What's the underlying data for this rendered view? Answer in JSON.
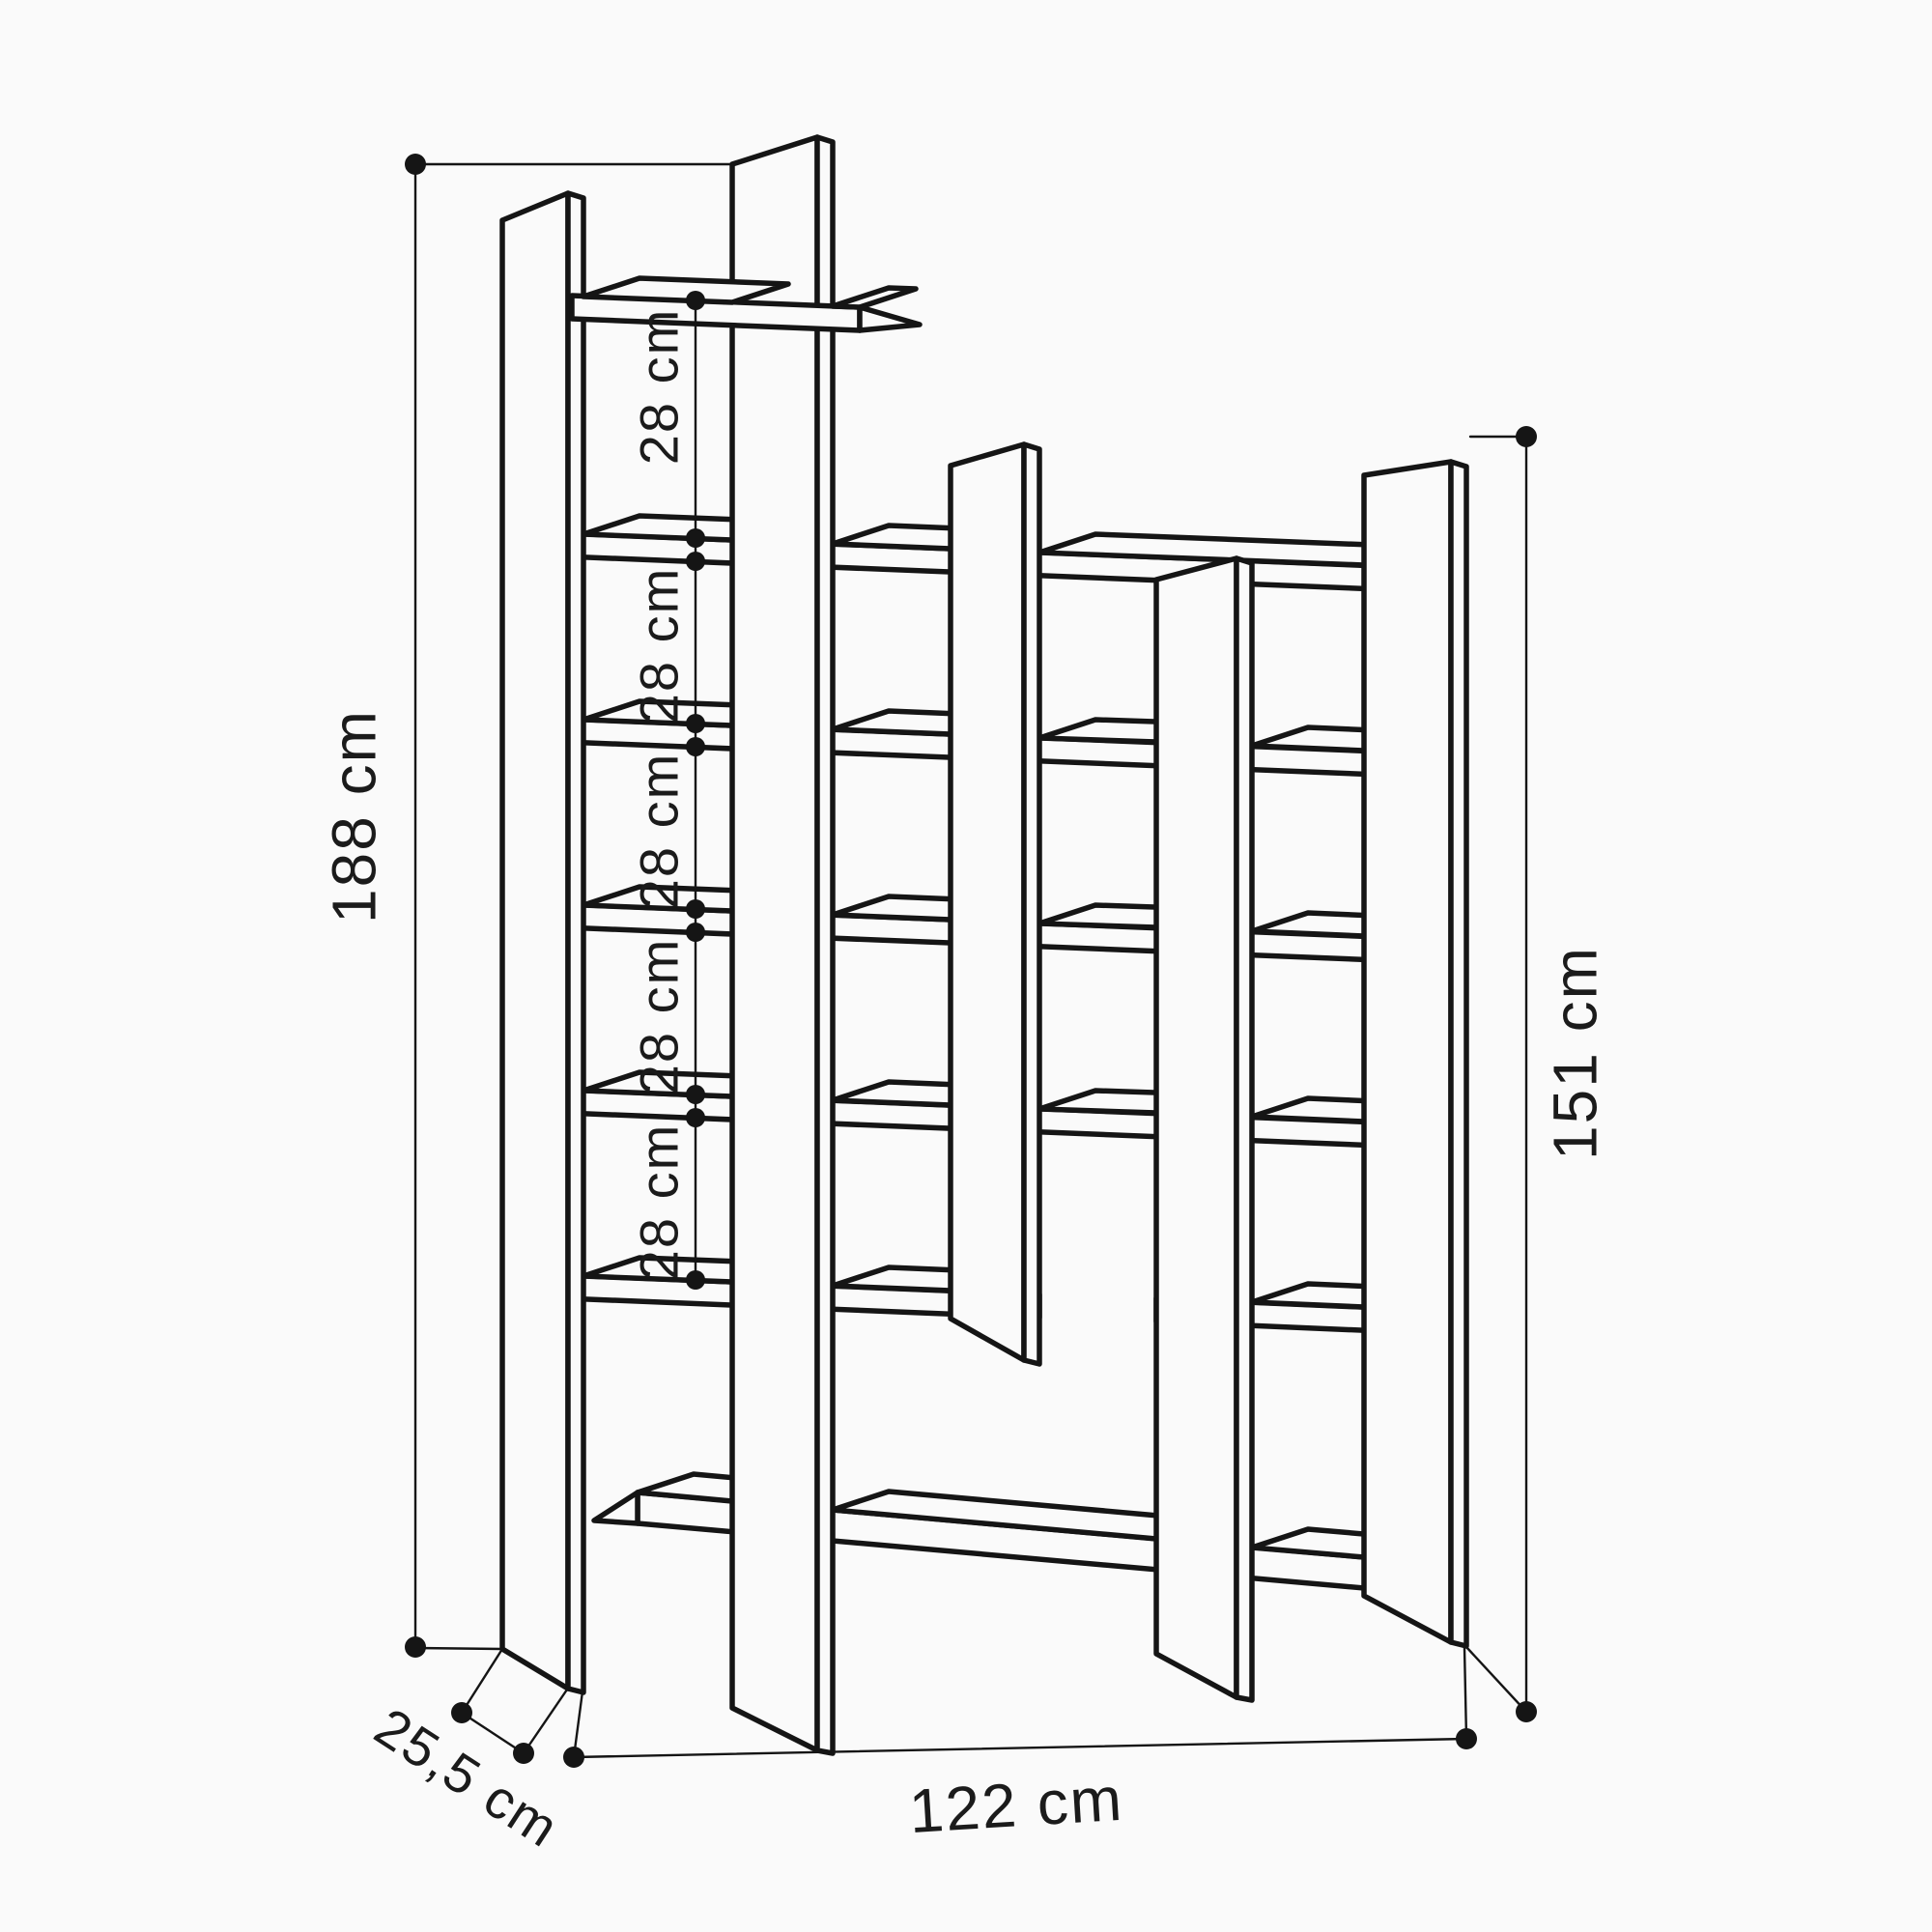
{
  "page": {
    "background": "#fafafa",
    "line_color": "#151515"
  },
  "diagram": {
    "kind": "furniture-dimension-drawing",
    "subject": "asymmetric open bookshelf drawn in perspective line style",
    "dimensions": {
      "overall_height_left": "188 cm",
      "height_right": "151 cm",
      "overall_width": "122 cm",
      "depth": "25,5 cm",
      "shelf_gap_1": "28 cm",
      "shelf_gap_2": "28 cm",
      "shelf_gap_3": "28 cm",
      "shelf_gap_4": "28 cm",
      "shelf_gap_5": "28 cm"
    }
  }
}
